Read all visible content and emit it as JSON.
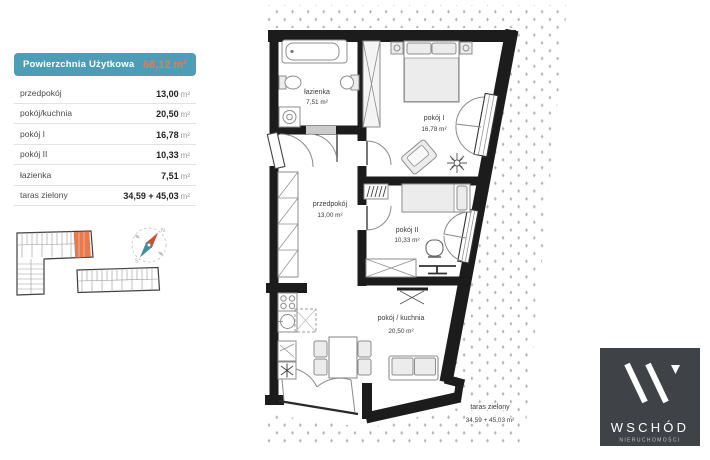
{
  "panel": {
    "header": {
      "title": "Powierzchnia Użytkowa",
      "total": "68,12 m²"
    },
    "rows": [
      {
        "label": "przedpokój",
        "value": "13,00",
        "unit": "m²"
      },
      {
        "label": "pokój/kuchnia",
        "value": "20,50",
        "unit": "m²"
      },
      {
        "label": "pokój I",
        "value": "16,78",
        "unit": "m²"
      },
      {
        "label": "pokój II",
        "value": "10,33",
        "unit": "m²"
      },
      {
        "label": "łazienka",
        "value": "7,51",
        "unit": "m²"
      },
      {
        "label": "taras zielony",
        "value": "34,59 + 45,03",
        "unit": "m²"
      }
    ],
    "colors": {
      "teal": "#4e9db6",
      "orange": "#e87a4c"
    }
  },
  "floorplan": {
    "rooms": [
      {
        "name": "łazienka",
        "area": "7,51 m²"
      },
      {
        "name": "pokój I",
        "area": "16,78 m²"
      },
      {
        "name": "przedpokój",
        "area": "13,00 m²"
      },
      {
        "name": "pokój II",
        "area": "10,33 m²"
      },
      {
        "name": "pokój / kuchnia",
        "area": "20,50 m²"
      },
      {
        "name": "taras zielony",
        "area": "34,59 + 45,03 m²"
      }
    ],
    "compass": {
      "north": "N",
      "south": "S"
    }
  },
  "logo": {
    "brand": "WSCHÓD",
    "subtitle": "NIERUCHOMOŚCI",
    "bg": "#3f4348"
  }
}
